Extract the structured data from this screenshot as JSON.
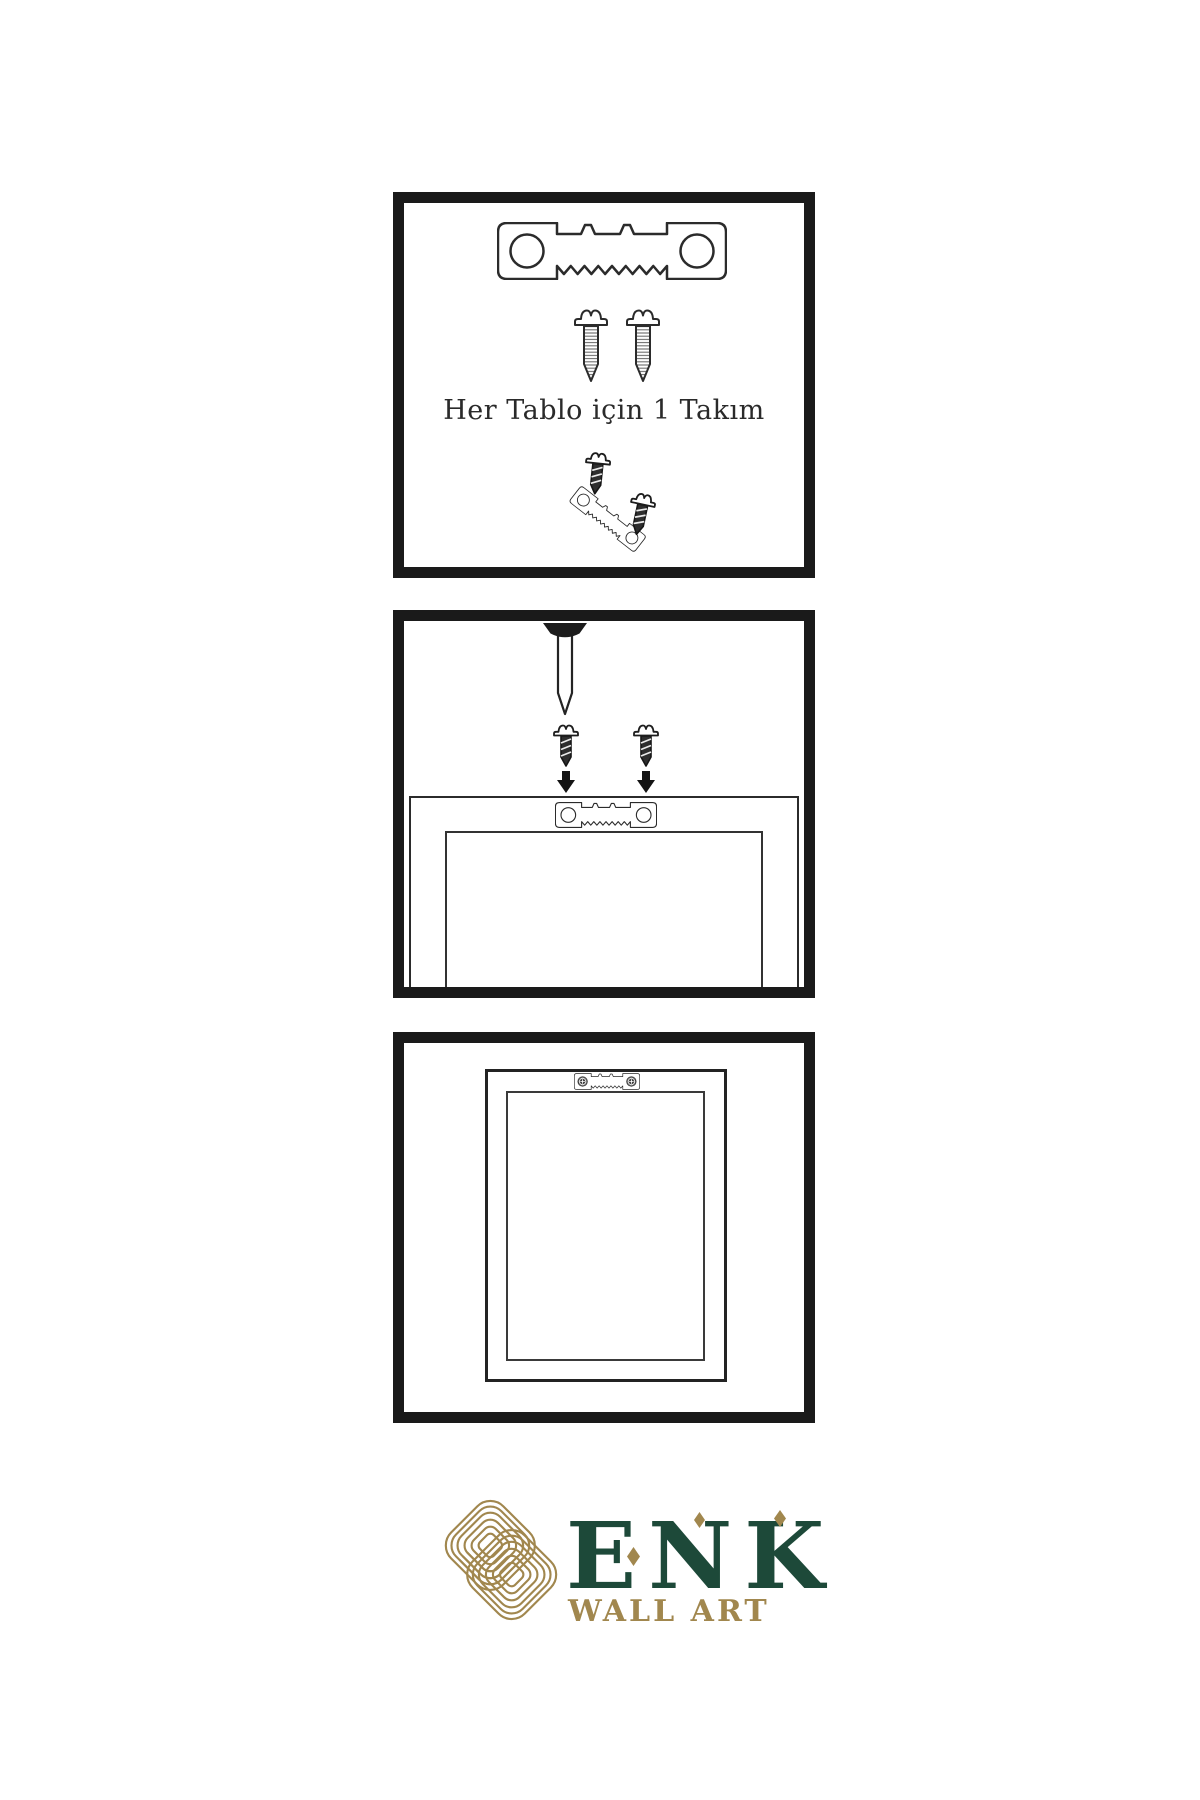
{
  "page": {
    "background": "#ffffff"
  },
  "palette": {
    "ink": "#2b2b2b",
    "panel_border": "#1a1a1a",
    "logo_green": "#1d4939",
    "logo_gold": "#a1874e"
  },
  "steps": [
    {
      "caption": "Her Tablo için 1 Takım",
      "icons": [
        "sawtooth-hanger-icon",
        "screw-icon",
        "screw-icon",
        "screw-into-hanger-icon"
      ]
    },
    {
      "icons": [
        "nail-icon",
        "screw-icon",
        "screw-icon",
        "down-arrow-icon",
        "down-arrow-icon",
        "frame-back-icon",
        "sawtooth-hanger-icon"
      ]
    },
    {
      "icons": [
        "frame-front-icon",
        "mounted-sawtooth-hanger-icon"
      ]
    }
  ],
  "logo": {
    "brand": "ENK",
    "subtitle": "WALL ART",
    "icon": "interlocking-knot-icon"
  }
}
